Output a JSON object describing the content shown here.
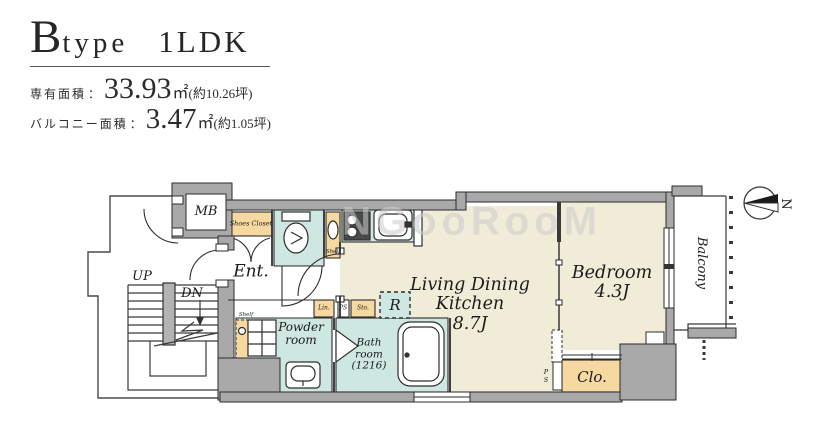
{
  "header": {
    "title": {
      "letter": "B",
      "word": "type",
      "suffix": "1LDK"
    },
    "areas": [
      {
        "label": "専有面積",
        "separator": "：",
        "value": "33.93",
        "unit": "㎡",
        "note": "(約10.26坪)"
      },
      {
        "label": "バルコニー面積",
        "separator": "：",
        "value": "3.47",
        "unit": "㎡",
        "note": "(約1.05坪)"
      }
    ]
  },
  "plan": {
    "watermark": "NGooRooM",
    "compass_label": "N",
    "labels": {
      "mb": "MB",
      "shoes_closet": "Shoes Closet",
      "ent": "Ent.",
      "up": "UP",
      "dn": "DN",
      "toilet_shelf": "Shelf",
      "washer_shelf": "Shelf",
      "linen": "Lin.",
      "pipe_space_small": "PS",
      "storage": "Sto.",
      "refrigerator": "R",
      "powder_room": "Powder\nroom",
      "bath_room": "Bath\nroom\n(1216)",
      "ldk": "Living Dining\nKitchen\n8.7J",
      "bedroom": "Bedroom\n4.3J",
      "closet": "Clo.",
      "pipe_space_vertical": "P\nS",
      "balcony": "Balcony"
    }
  },
  "colors": {
    "wall": "#a9a9a9",
    "wet_area": "#cfe7e1",
    "storage_area": "#f6d8a1",
    "floor": "#f0ecd7",
    "outline": "#2e2e2e"
  }
}
